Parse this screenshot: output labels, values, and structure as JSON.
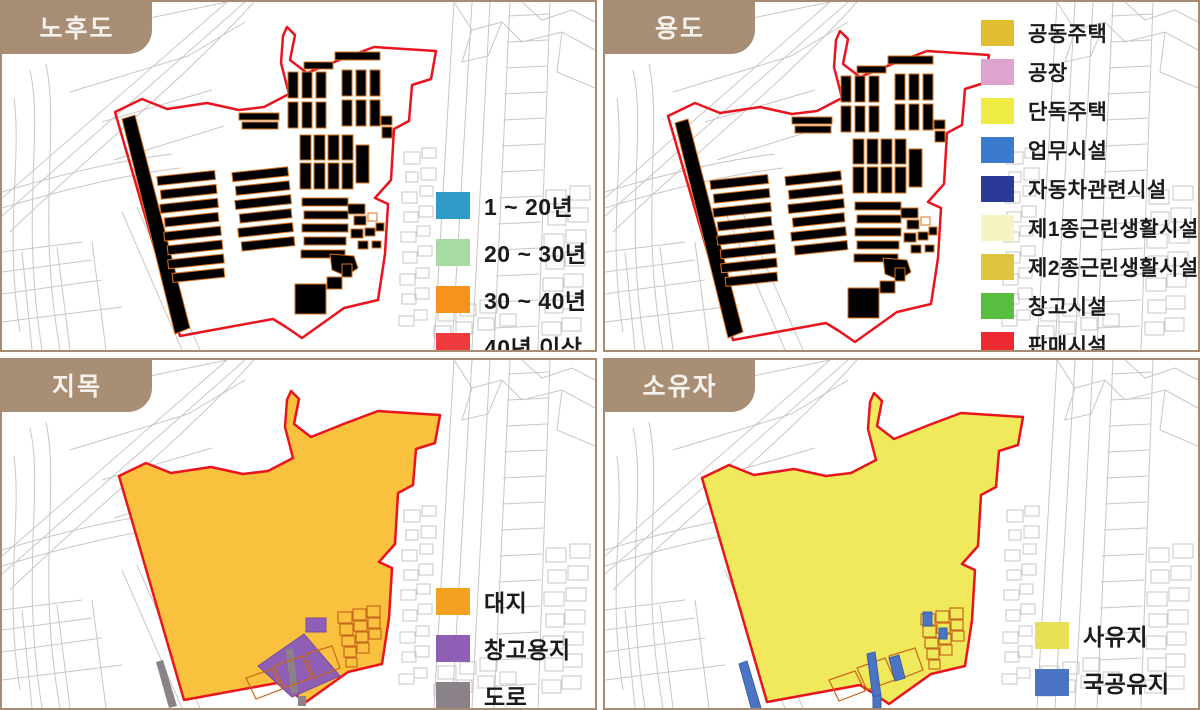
{
  "panels": [
    {
      "id": "aging",
      "title": "노후도",
      "legend": [
        {
          "label": "1 ~ 20년",
          "color": "#2E9BC9"
        },
        {
          "label": "20 ~ 30년",
          "color": "#A8DBA2"
        },
        {
          "label": "30 ~ 40년",
          "color": "#F6921E"
        },
        {
          "label": "40년 이상",
          "color": "#EE3A3C"
        }
      ]
    },
    {
      "id": "use",
      "title": "용도",
      "legend": [
        {
          "label": "공동주택",
          "color": "#E0BE30"
        },
        {
          "label": "공장",
          "color": "#DFA3D0"
        },
        {
          "label": "단독주택",
          "color": "#EFEC44"
        },
        {
          "label": "업무시설",
          "color": "#3A7BCE"
        },
        {
          "label": "자동차관련시설",
          "color": "#2B3A96"
        },
        {
          "label": "제1종근린생활시설",
          "color": "#F6F4C2"
        },
        {
          "label": "제2종근린생활시설",
          "color": "#DEC53E"
        },
        {
          "label": "창고시설",
          "color": "#58BE3F"
        },
        {
          "label": "판매시설",
          "color": "#EE2B33"
        }
      ]
    },
    {
      "id": "jimok",
      "title": "지목",
      "legend": [
        {
          "label": "대지",
          "color": "#F4A120"
        },
        {
          "label": "창고용지",
          "color": "#8F5EB5"
        },
        {
          "label": "도로",
          "color": "#8A8288"
        }
      ]
    },
    {
      "id": "owner",
      "title": "소유자",
      "legend": [
        {
          "label": "사유지",
          "color": "#E8E057"
        },
        {
          "label": "국공유지",
          "color": "#4B74C5"
        }
      ]
    }
  ],
  "map_colors": {
    "outline": "#E8151E",
    "bstroke": "#D9731E",
    "pstroke": "#C9681C",
    "line": "#CBC6C6",
    "border": "#A88C72",
    "tab": "#A78E74",
    "tabtext": "#F5F1EC",
    "landfill": "#F9C13D",
    "ownerfill": "#F0E95C"
  }
}
